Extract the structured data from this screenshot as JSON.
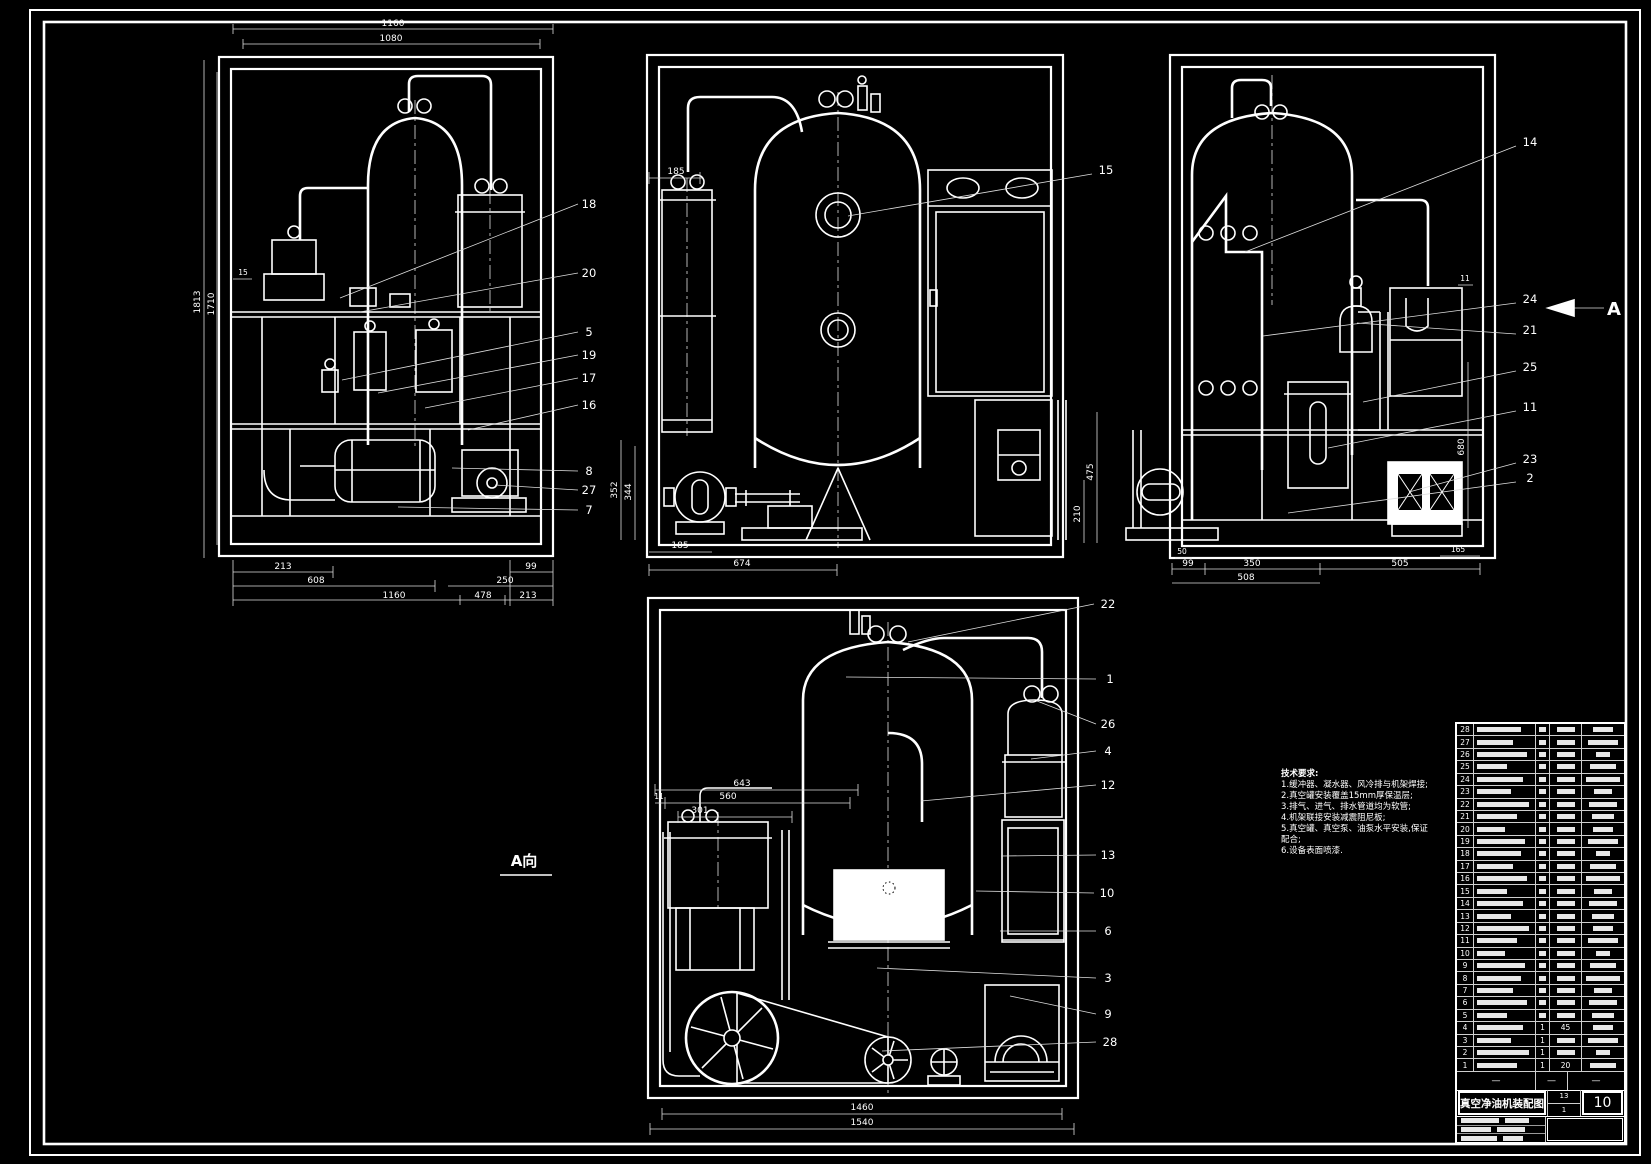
{
  "canvas": {
    "bg": "#000000",
    "line_color": "#ffffff"
  },
  "title_block": {
    "title": "真空净油机装配图",
    "sheet_no": "10",
    "mid_top": "13",
    "mid_bottom": "1",
    "dash": "—"
  },
  "a_view_label": "A向",
  "arrow_label": "A",
  "tech_requirements": {
    "heading": "技术要求:",
    "lines": [
      "1.缓冲器、凝水器、风冷排与机架焊接;",
      "2.真空罐安装覆盖15mm厚保温层;",
      "3.排气、进气、排水管道均为软管;",
      "4.机架联接安装减震阻尼板;",
      "5.真空罐、真空泵、油泵水平安装,保证",
      "配合;",
      "6.设备表面喷漆."
    ]
  },
  "v1": {
    "dims": {
      "top_outer": "1160",
      "top_inner": "1080",
      "height_outer": "1813",
      "height_inner": "1710",
      "small": "15",
      "b1a": "213",
      "b1b": "99",
      "b2a": "608",
      "b2b": "250",
      "b3a": "1160",
      "b3b": "478",
      "b3c": "213"
    },
    "callouts": [
      "18",
      "20",
      "5",
      "19",
      "17",
      "16",
      "8",
      "27",
      "7"
    ]
  },
  "v2": {
    "dims": {
      "top": "185",
      "v1": "352",
      "v2": "344",
      "b_small": "185",
      "b": "674",
      "r1": "475",
      "r2": "210"
    },
    "callouts": [
      "15"
    ]
  },
  "v3": {
    "dims": {
      "small_top": "11",
      "right": "680",
      "bl": "50",
      "b1a": "99",
      "b1b": "350",
      "b1c": "505",
      "b2": "508",
      "br": "165"
    },
    "callouts": [
      "14",
      "24",
      "21",
      "25",
      "11",
      "23",
      "2"
    ]
  },
  "v4": {
    "dims": {
      "l1": "643",
      "l1s": "11",
      "l2": "560",
      "l3": "301",
      "b1": "1460",
      "b2": "1540"
    },
    "callouts": [
      "22",
      "1",
      "26",
      "4",
      "12",
      "13",
      "10",
      "6",
      "3",
      "9",
      "28"
    ]
  },
  "parts_table": {
    "row_nos": [
      "28",
      "27",
      "26",
      "25",
      "24",
      "23",
      "22",
      "21",
      "20",
      "19",
      "18",
      "17",
      "16",
      "15",
      "14",
      "13",
      "12",
      "11",
      "10",
      "9",
      "8",
      "7",
      "6",
      "5",
      "4",
      "3",
      "2",
      "1"
    ],
    "extras": {
      "4": "45",
      "1": "20"
    },
    "qty_rows": [
      "4",
      "3",
      "2",
      "1"
    ],
    "qty_value": "1"
  }
}
